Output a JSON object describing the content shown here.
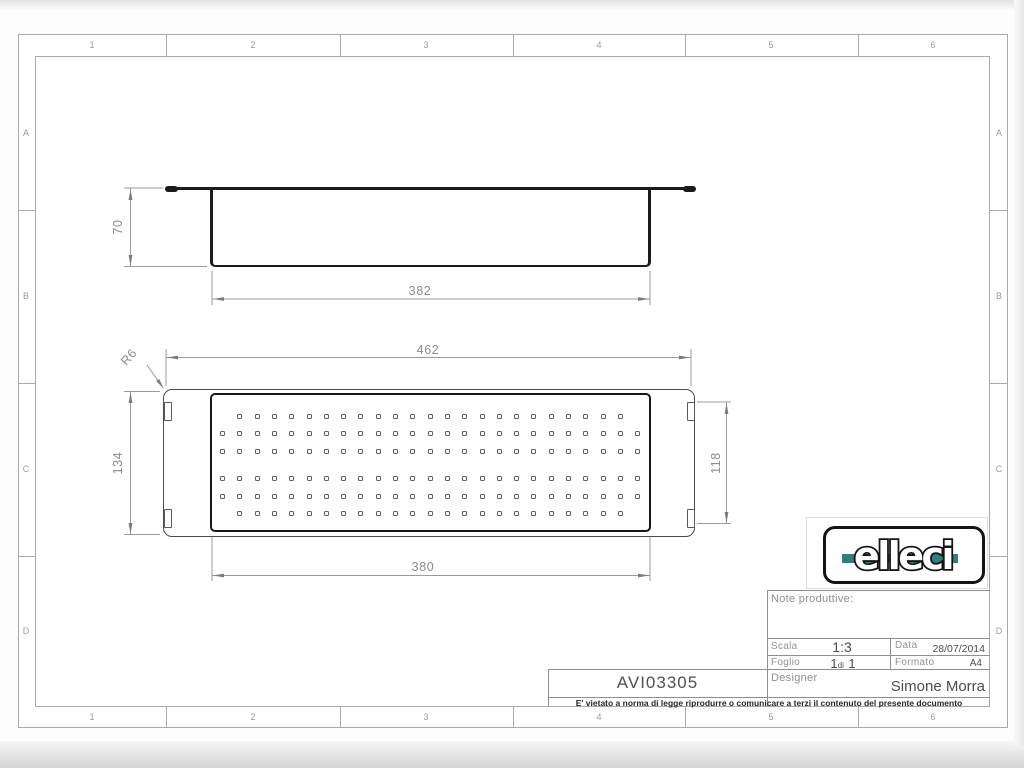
{
  "sheet": {
    "cols": [
      "1",
      "2",
      "3",
      "4",
      "5",
      "6"
    ],
    "rows": [
      "A",
      "B",
      "C",
      "D"
    ]
  },
  "views": {
    "side": {
      "height_dim": "70",
      "width_dim": "382"
    },
    "top": {
      "width_dim": "462",
      "inner_width_dim": "380",
      "height_dim": "134",
      "inner_height_dim": "118",
      "radius_label": "R6"
    }
  },
  "perforation": {
    "pitch": 17.3,
    "hole_size": 5,
    "rows": [
      {
        "y": 413.5,
        "count": 23,
        "start": 237.3
      },
      {
        "y": 431.0,
        "count": 25,
        "start": 220.0
      },
      {
        "y": 448.5,
        "count": 25,
        "start": 220.0
      },
      {
        "y": 476.0,
        "count": 25,
        "start": 220.0
      },
      {
        "y": 493.5,
        "count": 25,
        "start": 220.0
      },
      {
        "y": 510.5,
        "count": 23,
        "start": 237.3
      }
    ]
  },
  "logo": {
    "text": "elleci"
  },
  "title_block": {
    "note_label": "Note produttive:",
    "scala_label": "Scala",
    "scala_value": "1:3",
    "data_label": "Data",
    "data_value": "28/07/2014",
    "foglio_label": "Foglio",
    "foglio_num1": "1",
    "foglio_di": "di",
    "foglio_num2": "1",
    "formato_label": "Formato",
    "formato_value": "A4",
    "designer_label": "Designer",
    "designer_value": "Simone Morra",
    "part_number": "AVI03305",
    "disclaimer": "E' vietato a norma di legge riprodurre o comunicare a terzi il contenuto del presente documento"
  },
  "colors": {
    "part_line": "#1c1c1c",
    "dim_line": "#9b9b9b",
    "dim_text": "#8c8c8c",
    "frame_line": "#a9a9a9",
    "logo_accent_teal": "#2e7f7d"
  }
}
